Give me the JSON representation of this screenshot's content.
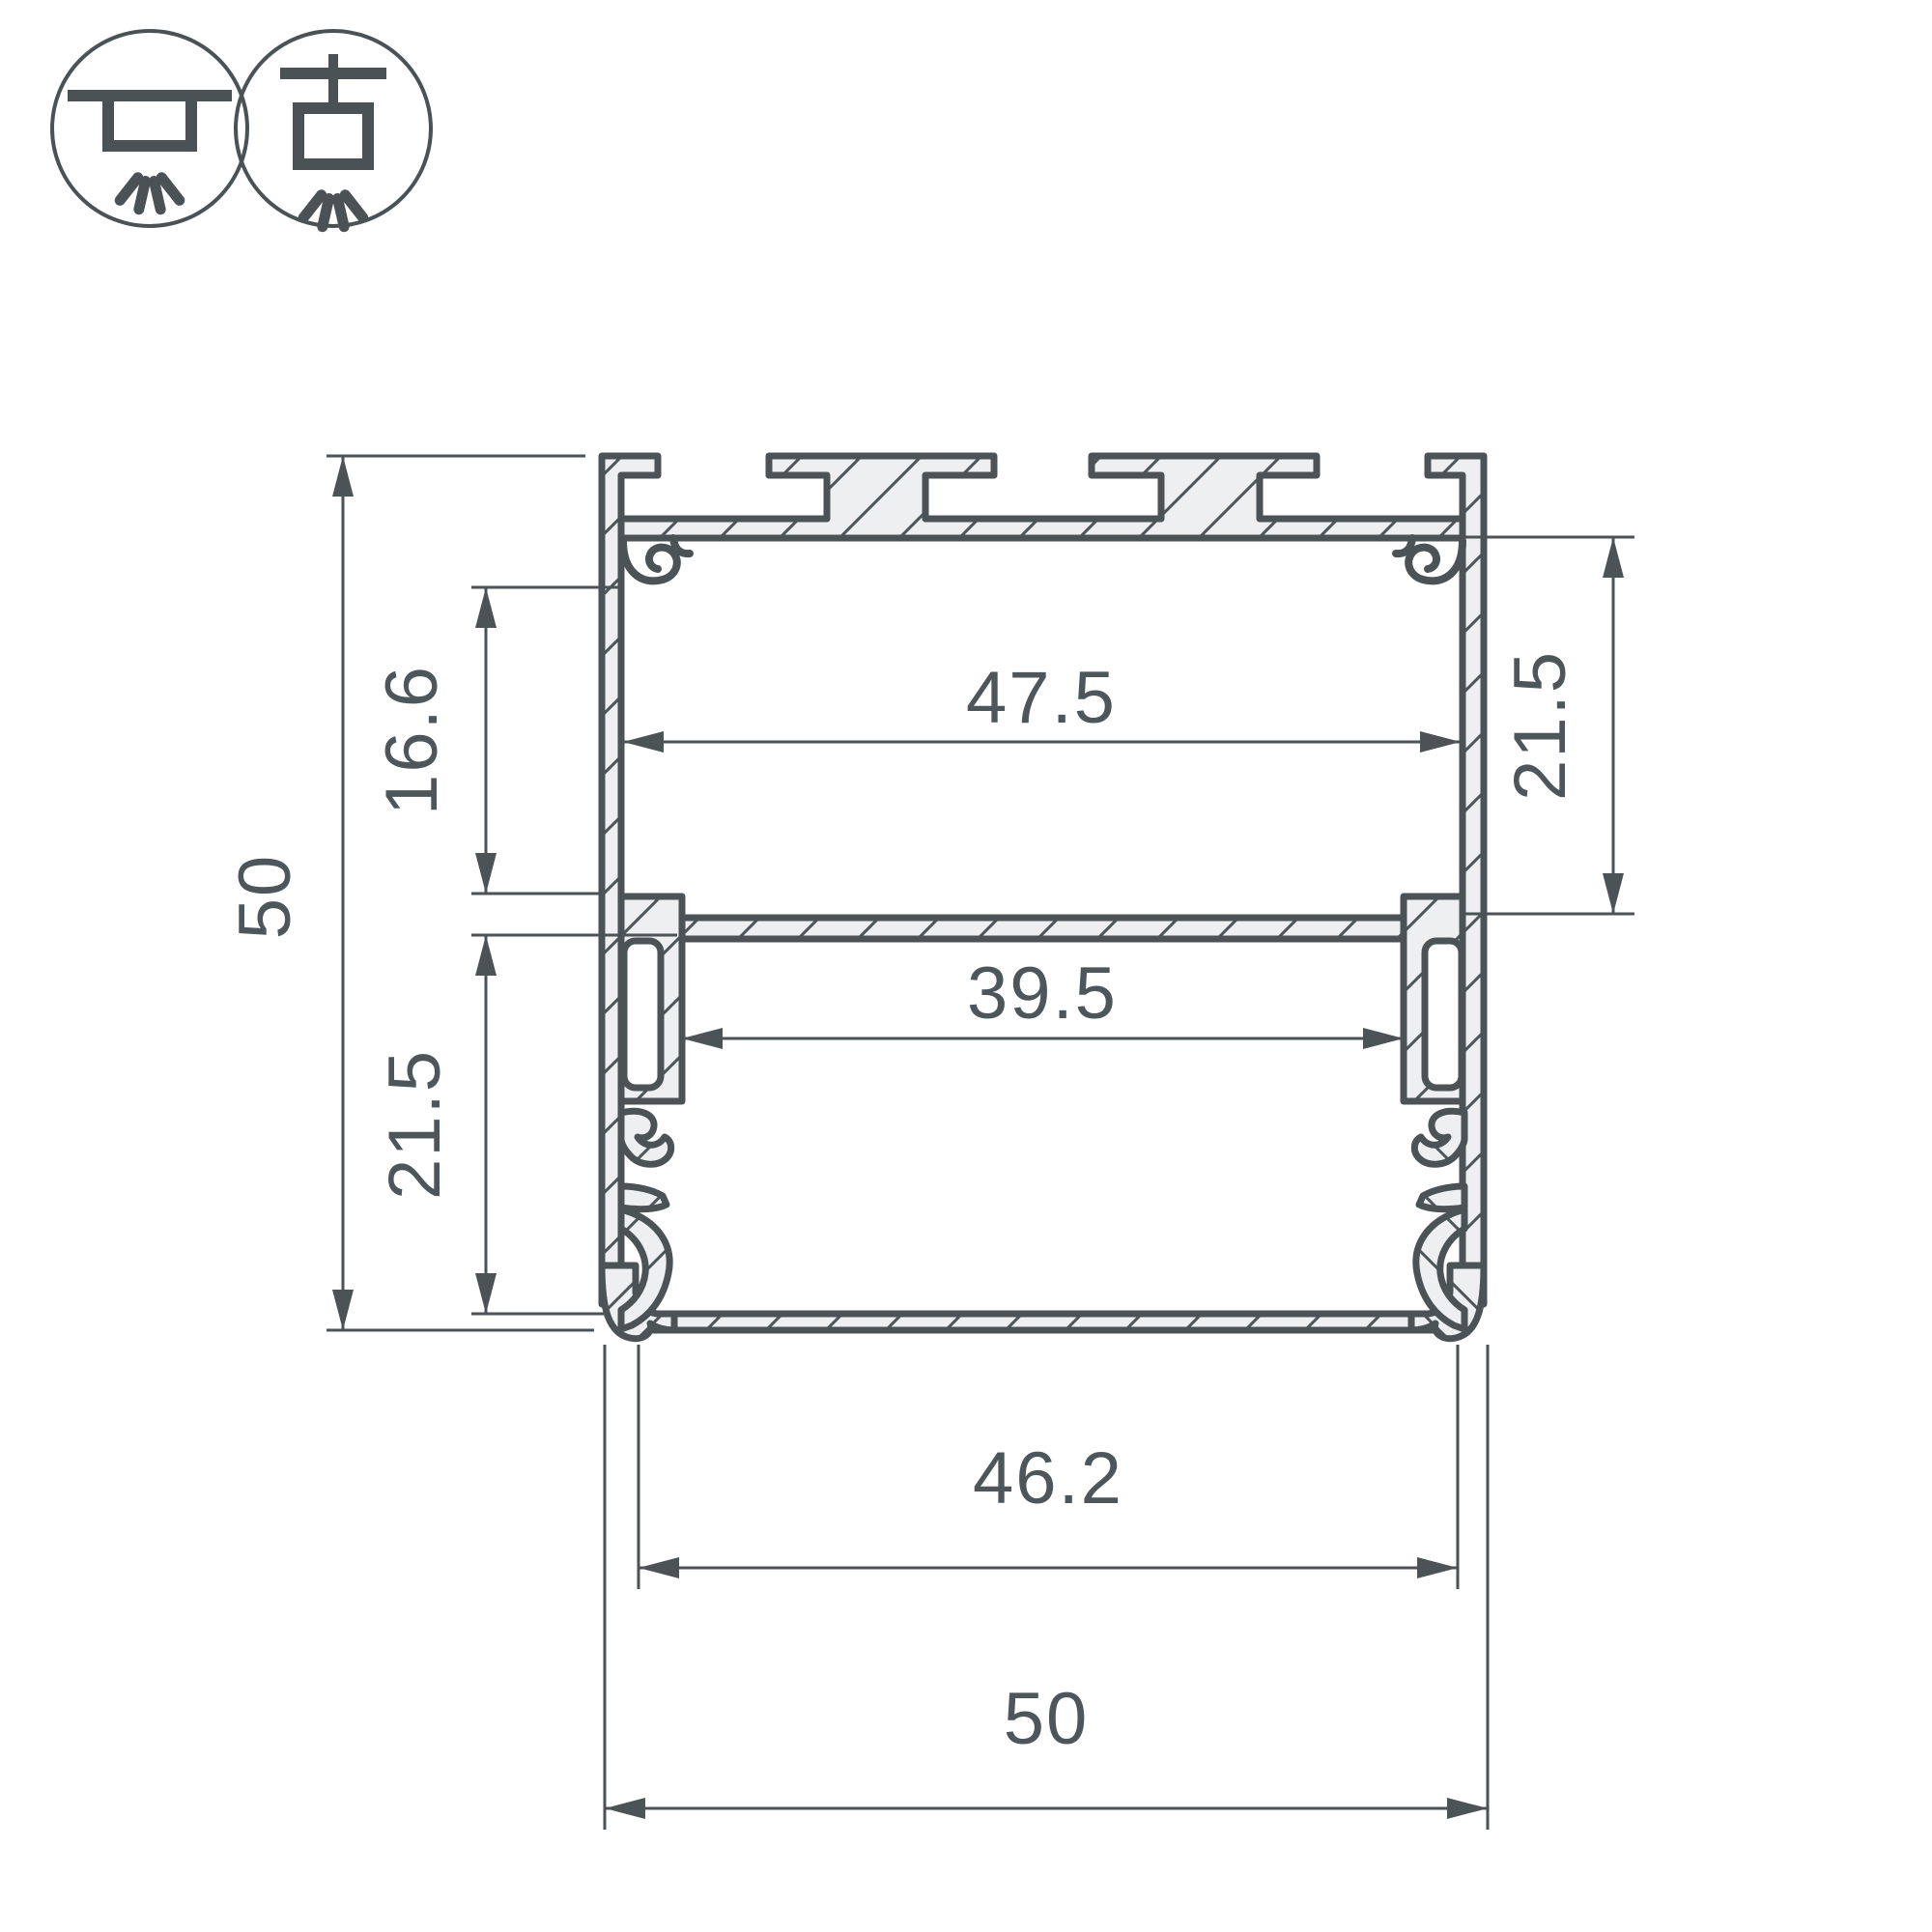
{
  "drawing": {
    "type": "technical-cross-section",
    "subject": "aluminum-led-profile",
    "colors": {
      "line": "#4b5357",
      "fill": "#edeff0",
      "background": "#ffffff",
      "text": "#4d565a"
    },
    "icons": [
      {
        "name": "surface-mount-icon"
      },
      {
        "name": "pendant-mount-icon"
      }
    ],
    "dimensions": {
      "overall_height": {
        "label": "50"
      },
      "upper_inner_height": {
        "label": "16.6"
      },
      "lower_inner_height": {
        "label": "21.5"
      },
      "upper_inner_width": {
        "label": "47.5"
      },
      "right_cavity_height": {
        "label": "21.5"
      },
      "shelf_window_width": {
        "label": "39.5"
      },
      "lower_inner_width": {
        "label": "46.2"
      },
      "overall_width": {
        "label": "50"
      }
    }
  }
}
